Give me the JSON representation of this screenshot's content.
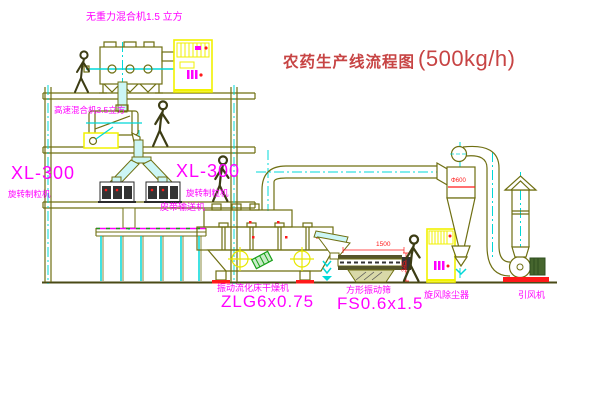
{
  "title": {
    "cn": "农药生产线流程图",
    "rate": "(500kg/h)"
  },
  "equipment_labels": {
    "gravity_mixer": "无重力混合机1.5 立方",
    "high_speed_mixer": "高速混合机3.5立方",
    "xl300_left_model": "XL-300",
    "xl300_left_name": "旋转制粒机",
    "xl300_center_model": "XL-300",
    "xl300_center_name": "旋转制粒机",
    "belt_conveyor": "皮带输送机",
    "dryer_name": "振动流化床干燥机",
    "dryer_model": "ZLG6x0.75",
    "sieve_name": "方形振动筛",
    "sieve_model": "FS0.6x1.5",
    "cyclone": "旋风除尘器",
    "fan": "引风机"
  },
  "dimensions": {
    "sieve_length": "1500",
    "sieve_height": "345",
    "cyclone_dia": "Φ600"
  },
  "colors": {
    "structure_olive": "#6f6f12",
    "centerline_cyan": "#00d8d8",
    "label_magenta": "#ff00ff",
    "title_red": "#c74444",
    "dimension_red": "#ff1a1a",
    "cabinet_yellow": "#f2f200",
    "motor_green": "#18a018",
    "ground_dark": "#4a4a16"
  },
  "icons": [
    "person-figure",
    "control-cabinet",
    "crosshair-level-icon",
    "flow-arrow-icon",
    "cyclone-separator",
    "exhaust-stack",
    "induced-draft-fan"
  ]
}
